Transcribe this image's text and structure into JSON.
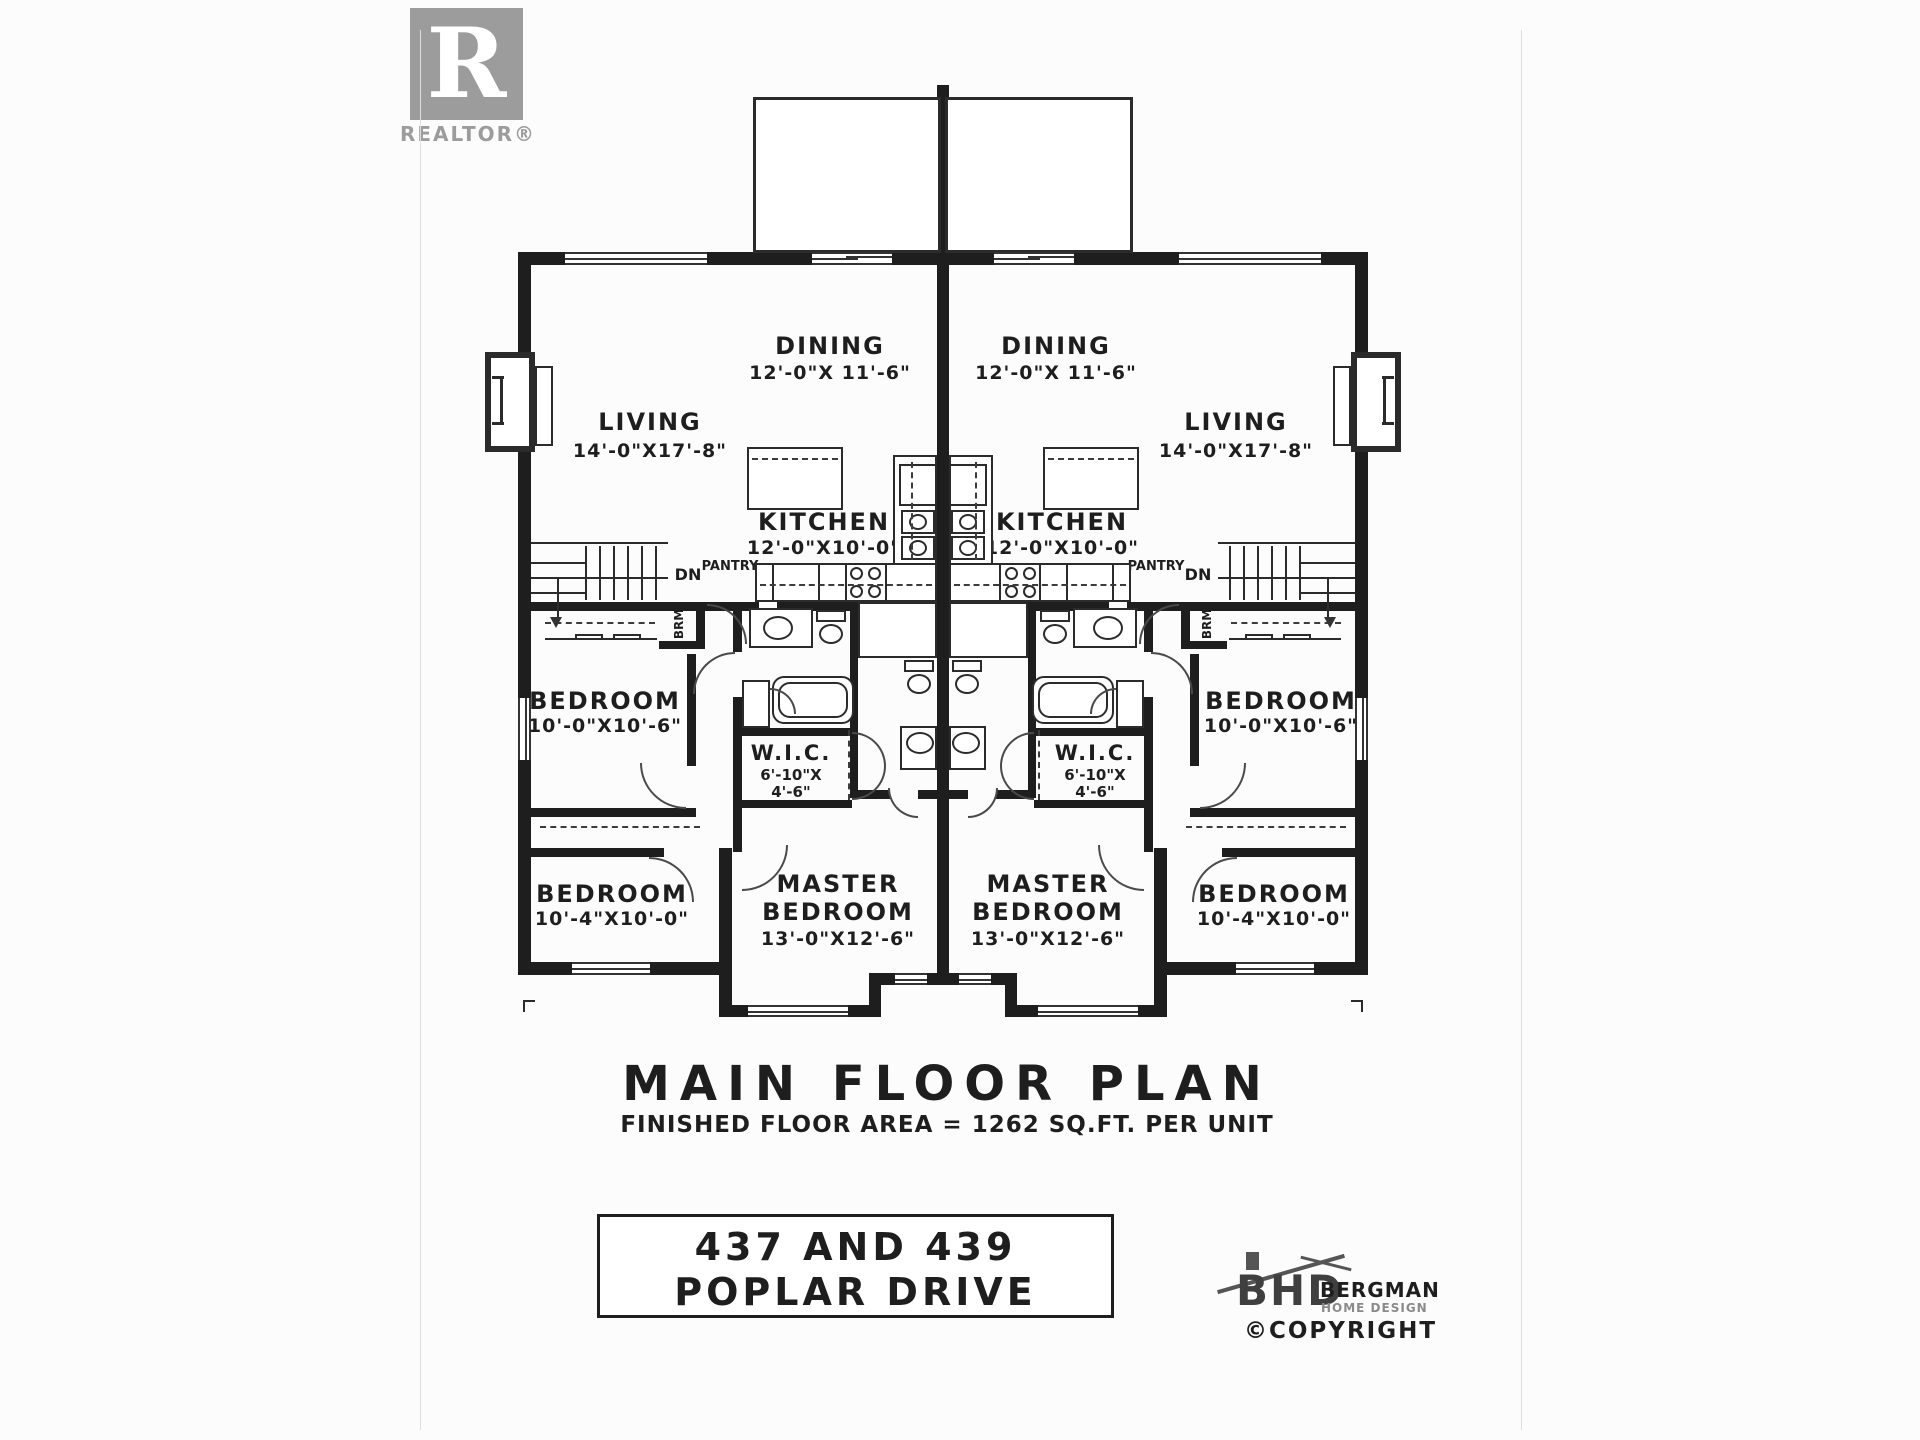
{
  "branding": {
    "realtor": {
      "logo_letter": "R",
      "label": "REALTOR®"
    },
    "designer": {
      "acronym": "BHD",
      "name": "BERGMAN",
      "subtitle": "HOME DESIGN",
      "copyright": "©COPYRIGHT"
    }
  },
  "title_block": {
    "title": "MAIN FLOOR PLAN",
    "subtitle": "FINISHED FLOOR AREA = 1262 SQ.FT. PER UNIT",
    "address_line1": "437 AND 439",
    "address_line2": "POPLAR DRIVE"
  },
  "rooms": {
    "patio": {
      "label": "PATIO",
      "dims": "12'-0\"X10'-0\""
    },
    "dining": {
      "label": "DINING",
      "dims": "12'-0\"X 11'-6\""
    },
    "living": {
      "label": "LIVING",
      "dims": "14'-0\"X17'-8\""
    },
    "kitchen": {
      "label": "KITCHEN",
      "dims": "12'-0\"X10'-0\""
    },
    "bedroom1": {
      "label": "BEDROOM",
      "dims": "10'-0\"X10'-6\""
    },
    "bedroom2": {
      "label": "BEDROOM",
      "dims": "10'-4\"X10'-0\""
    },
    "master": {
      "label_line1": "MASTER",
      "label_line2": "BEDROOM",
      "dims": "13'-0\"X12'-6\""
    },
    "wic": {
      "label": "W.I.C.",
      "dims_line1": "6'-10\"X",
      "dims_line2": "4'-6\""
    },
    "shower": {
      "label": "SHOWER"
    }
  },
  "annotations": {
    "pantry": "PANTRY",
    "stairs_down": "DN",
    "broom_closet": "BRM",
    "linen_closet": "LINEN",
    "fridge": "F",
    "dishwasher": "DW"
  },
  "colors": {
    "wall": "#1e1e1e",
    "line": "#2b2b2b",
    "logo_gray": "#9c9c9c",
    "paper": "#fcfcfc"
  }
}
